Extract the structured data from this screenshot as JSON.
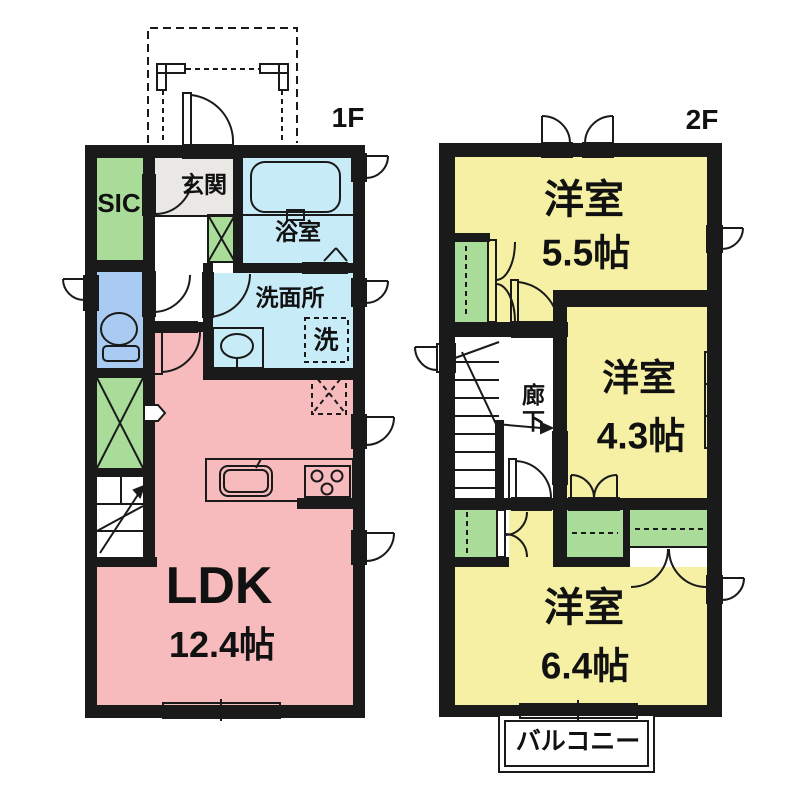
{
  "plan": {
    "floor1": {
      "floor_label": "1F",
      "sic": "SIC",
      "entrance": "玄関",
      "bathroom": "浴室",
      "washroom": "洗面所",
      "laundry": "洗",
      "ldk_name": "LDK",
      "ldk_size": "12.4帖"
    },
    "floor2": {
      "floor_label": "2F",
      "bedroom1_name": "洋室",
      "bedroom1_size": "5.5帖",
      "corridor": "廊下",
      "bedroom2_name": "洋室",
      "bedroom2_size": "4.3帖",
      "bedroom3_name": "洋室",
      "bedroom3_size": "6.4帖",
      "balcony": "バルコニー"
    },
    "colors": {
      "wall": "#1a1a1a",
      "ldk_pink": "#F7BBBD",
      "bedroom_yellow": "#F5F0A3",
      "closet_green": "#A9DC99",
      "toilet_blue": "#A9CBF1",
      "bath_blue": "#C8EBF8",
      "entrance_gray": "#E9E8E5",
      "bathtub_fill": "#D8F0FA"
    }
  }
}
